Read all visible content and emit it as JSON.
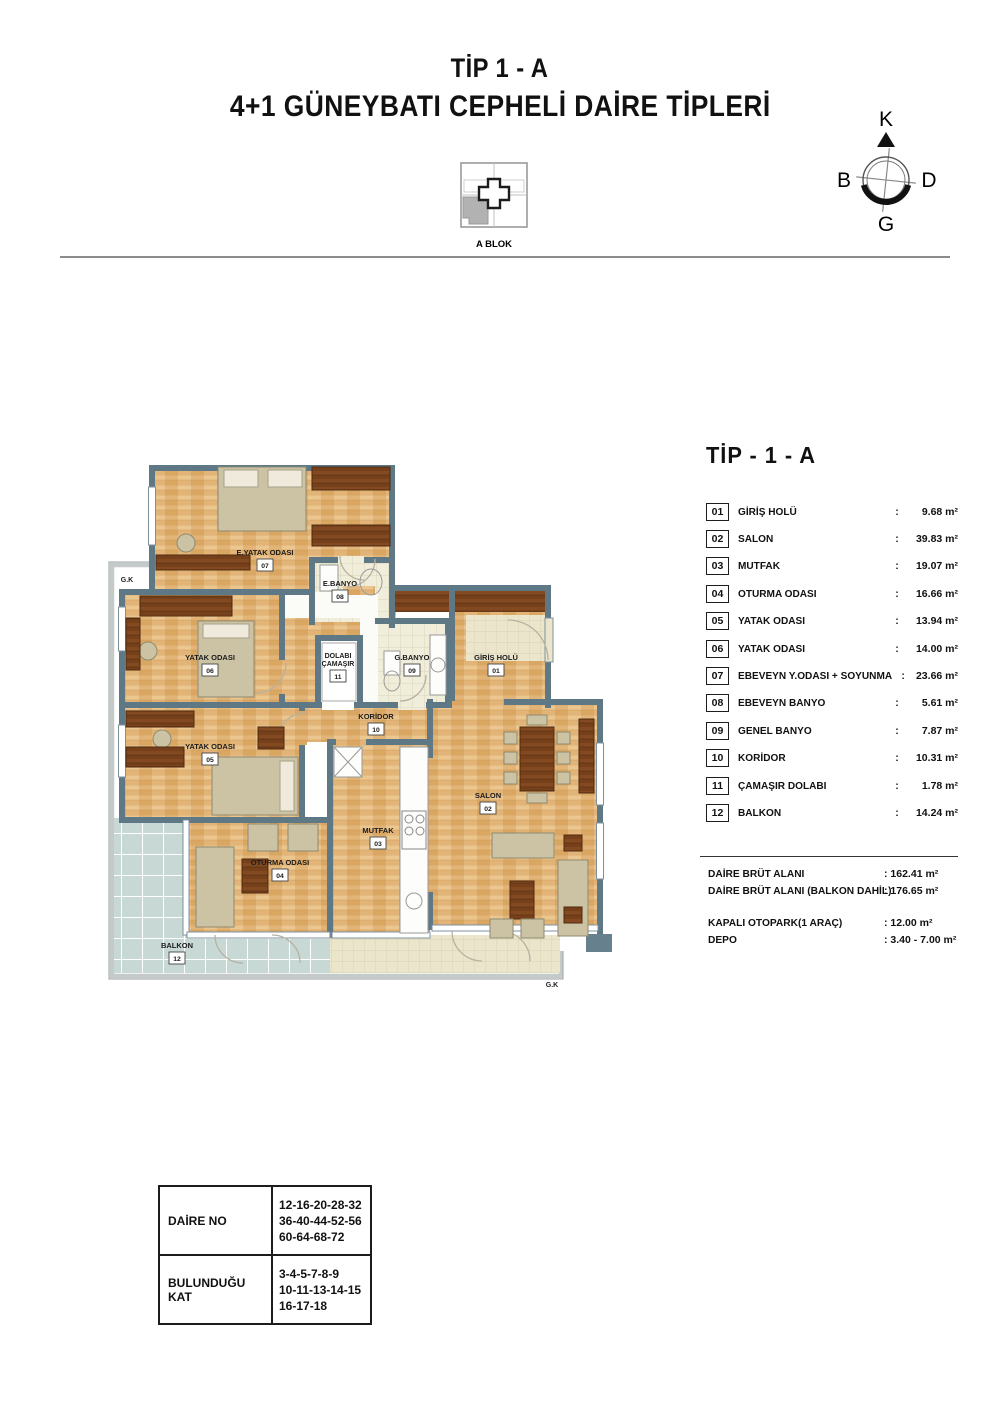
{
  "page": {
    "title_line1": "TİP 1 - A",
    "title_line2": "4+1 GÜNEYBATI CEPHELİ DAİRE TİPLERİ"
  },
  "compass": {
    "n": "K",
    "e": "D",
    "s": "G",
    "w": "B"
  },
  "block_key": {
    "label": "A BLOK"
  },
  "plan": {
    "gk": "G.K",
    "rooms": [
      {
        "no": "07",
        "line1": "E.YATAK ODASI"
      },
      {
        "no": "08",
        "line1": "E.BANYO"
      },
      {
        "no": "06",
        "line1": "YATAK ODASI"
      },
      {
        "no": "11",
        "line1": "DOLABI",
        "line2": "ÇAMAŞIR"
      },
      {
        "no": "09",
        "line1": "G.BANYO"
      },
      {
        "no": "01",
        "line1": "GİRİŞ HOLÜ"
      },
      {
        "no": "10",
        "line1": "KORİDOR"
      },
      {
        "no": "05",
        "line1": "YATAK ODASI"
      },
      {
        "no": "02",
        "line1": "SALON"
      },
      {
        "no": "03",
        "line1": "MUTFAK"
      },
      {
        "no": "04",
        "line1": "OTURMA ODASI"
      },
      {
        "no": "12",
        "line1": "BALKON"
      }
    ]
  },
  "legend": {
    "title": "TİP - 1 - A",
    "colon": ":",
    "items": [
      {
        "no": "01",
        "label": "GİRİŞ HOLÜ",
        "value": "9.68 m²"
      },
      {
        "no": "02",
        "label": "SALON",
        "value": "39.83 m²"
      },
      {
        "no": "03",
        "label": "MUTFAK",
        "value": "19.07 m²"
      },
      {
        "no": "04",
        "label": "OTURMA ODASI",
        "value": "16.66 m²"
      },
      {
        "no": "05",
        "label": "YATAK ODASI",
        "value": "13.94 m²"
      },
      {
        "no": "06",
        "label": "YATAK ODASI",
        "value": "14.00 m²"
      },
      {
        "no": "07",
        "label": "EBEVEYN Y.ODASI + SOYUNMA",
        "value": "23.66 m²"
      },
      {
        "no": "08",
        "label": "EBEVEYN BANYO",
        "value": "5.61 m²"
      },
      {
        "no": "09",
        "label": "GENEL BANYO",
        "value": "7.87 m²"
      },
      {
        "no": "10",
        "label": "KORİDOR",
        "value": "10.31 m²"
      },
      {
        "no": "11",
        "label": "ÇAMAŞIR DOLABI",
        "value": "1.78 m²"
      },
      {
        "no": "12",
        "label": "BALKON",
        "value": "14.24 m²"
      }
    ],
    "summary": [
      {
        "label": "DAİRE BRÜT ALANI",
        "value": ": 162.41 m²"
      },
      {
        "label": "DAİRE BRÜT ALANI (BALKON DAHİL)",
        "value": ": 176.65 m²"
      }
    ],
    "extras": [
      {
        "label": "KAPALI OTOPARK(1 ARAÇ)",
        "value": ": 12.00 m²"
      },
      {
        "label": "DEPO",
        "value": ": 3.40 - 7.00 m²"
      }
    ]
  },
  "info_table": {
    "rows": [
      {
        "label": "DAİRE NO",
        "lines": [
          "12-16-20-28-32",
          "36-40-44-52-56",
          "60-64-68-72"
        ]
      },
      {
        "label": "BULUNDUĞU KAT",
        "lines": [
          "3-4-5-7-8-9",
          "10-11-13-14-15",
          "16-17-18"
        ]
      }
    ]
  },
  "colors": {
    "wall": "#5e7886",
    "wood": "#e3b478",
    "dark_wood": "#77411c",
    "bath_tile": "#f0edda",
    "balcony_tile": "#c7d8d5",
    "furniture_beige": "#cbc3a4"
  }
}
